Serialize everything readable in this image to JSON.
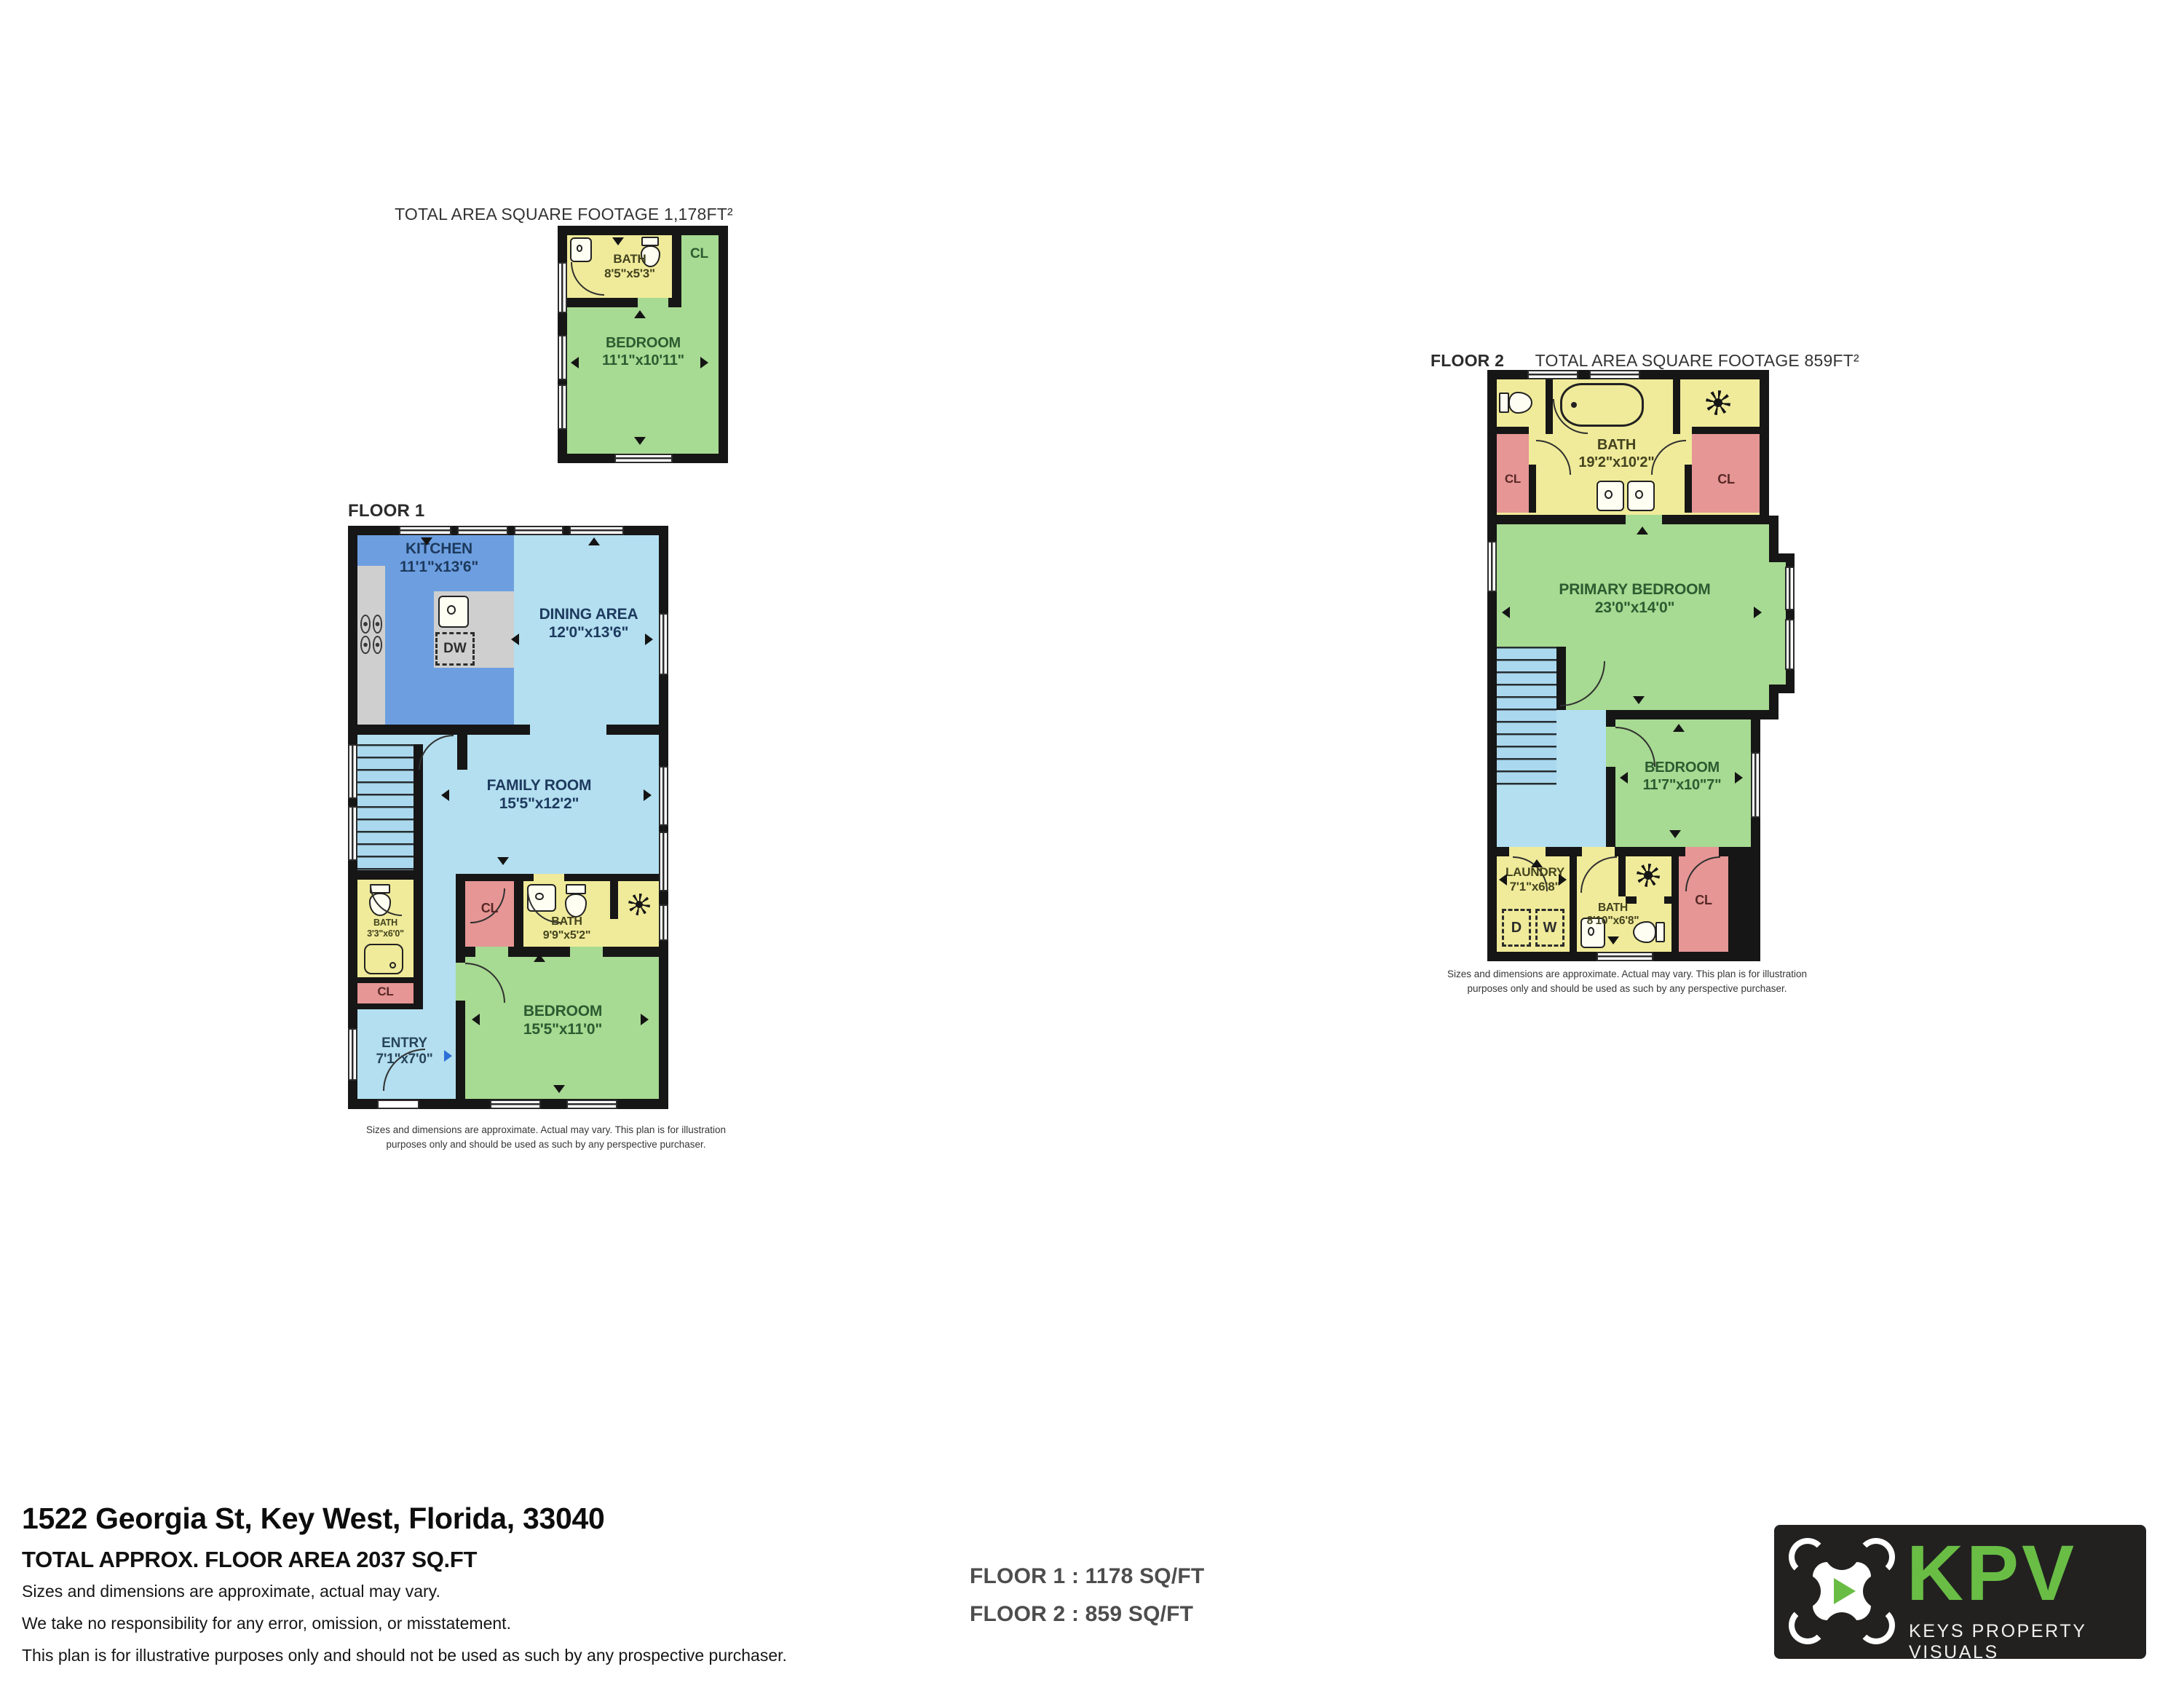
{
  "palette": {
    "wall": "#161616",
    "bath_yellow": "#f0eb9a",
    "bedroom_green": "#a7da92",
    "closet_pink": "#e59695",
    "living_light_blue": "#b3dff0",
    "kitchen_blue": "#6d9fe0",
    "counter_gray": "#cfcfcf",
    "stairs_blue": "#aad8ee",
    "logo_green": "#69bd45",
    "logo_background": "#222120"
  },
  "unit_plan": {
    "title": "TOTAL AREA SQUARE FOOTAGE 1,178FT²",
    "bath": {
      "name": "BATH",
      "dims": "8'5\"x5'3\""
    },
    "closet": "CL",
    "bedroom": {
      "name": "BEDROOM",
      "dims": "11'1\"x10'11\""
    }
  },
  "floor1": {
    "label": "FLOOR 1",
    "kitchen": {
      "name": "KITCHEN",
      "dims": "11'1\"x13'6\""
    },
    "dishwasher": "DW",
    "dining": {
      "name": "DINING AREA",
      "dims": "12'0\"x13'6\""
    },
    "family": {
      "name": "FAMILY ROOM",
      "dims": "15'5\"x12'2\""
    },
    "bath_small": {
      "name": "BATH",
      "dims": "3'3\"x6'0\""
    },
    "closet_hall": "CL",
    "entry": {
      "name": "ENTRY",
      "dims": "7'1\"x7'0\""
    },
    "closet_mid": "CL",
    "bath": {
      "name": "BATH",
      "dims": "9'9\"x5'2\""
    },
    "bedroom": {
      "name": "BEDROOM",
      "dims": "15'5\"x11'0\""
    },
    "disclaimer": [
      "Sizes and dimensions are approximate. Actual may vary. This plan is for illustration",
      "purposes only and should be used as such by any perspective purchaser."
    ]
  },
  "floor2": {
    "label": "FLOOR 2",
    "title": "TOTAL AREA SQUARE FOOTAGE 859FT²",
    "bath": {
      "name": "BATH",
      "dims": "19'2\"x10'2\""
    },
    "closet_left": "CL",
    "closet_right": "CL",
    "primary": {
      "name": "PRIMARY BEDROOM",
      "dims": "23'0\"x14'0\""
    },
    "bedroom": {
      "name": "BEDROOM",
      "dims": "11'7\"x10\"7\""
    },
    "laundry": {
      "name": "LAUNDRY",
      "dims": "7'1\"x6'8\""
    },
    "dryer": "D",
    "washer": "W",
    "bath2": {
      "name": "BATH",
      "dims": "8'10\"x6'8\""
    },
    "closet_bottom": "CL",
    "disclaimer": [
      "Sizes and dimensions are approximate. Actual may vary. This plan is for illustration",
      "purposes only and should be used as such by any perspective purchaser."
    ]
  },
  "footer": {
    "address": "1522 Georgia St, Key West, Florida, 33040",
    "total_area": "TOTAL APPROX. FLOOR AREA 2037 SQ.FT",
    "notes": [
      "Sizes and dimensions are approximate, actual may vary.",
      "We take no responsibility for any error, omission, or misstatement.",
      "This plan is for illustrative purposes only and should not be used as such by any prospective purchaser."
    ],
    "floor1_area": "FLOOR 1  :  1178 SQ/FT",
    "floor2_area": "FLOOR 2  :  859 SQ/FT"
  },
  "logo": {
    "abbr": "KPV",
    "name": "KEYS PROPERTY VISUALS"
  }
}
